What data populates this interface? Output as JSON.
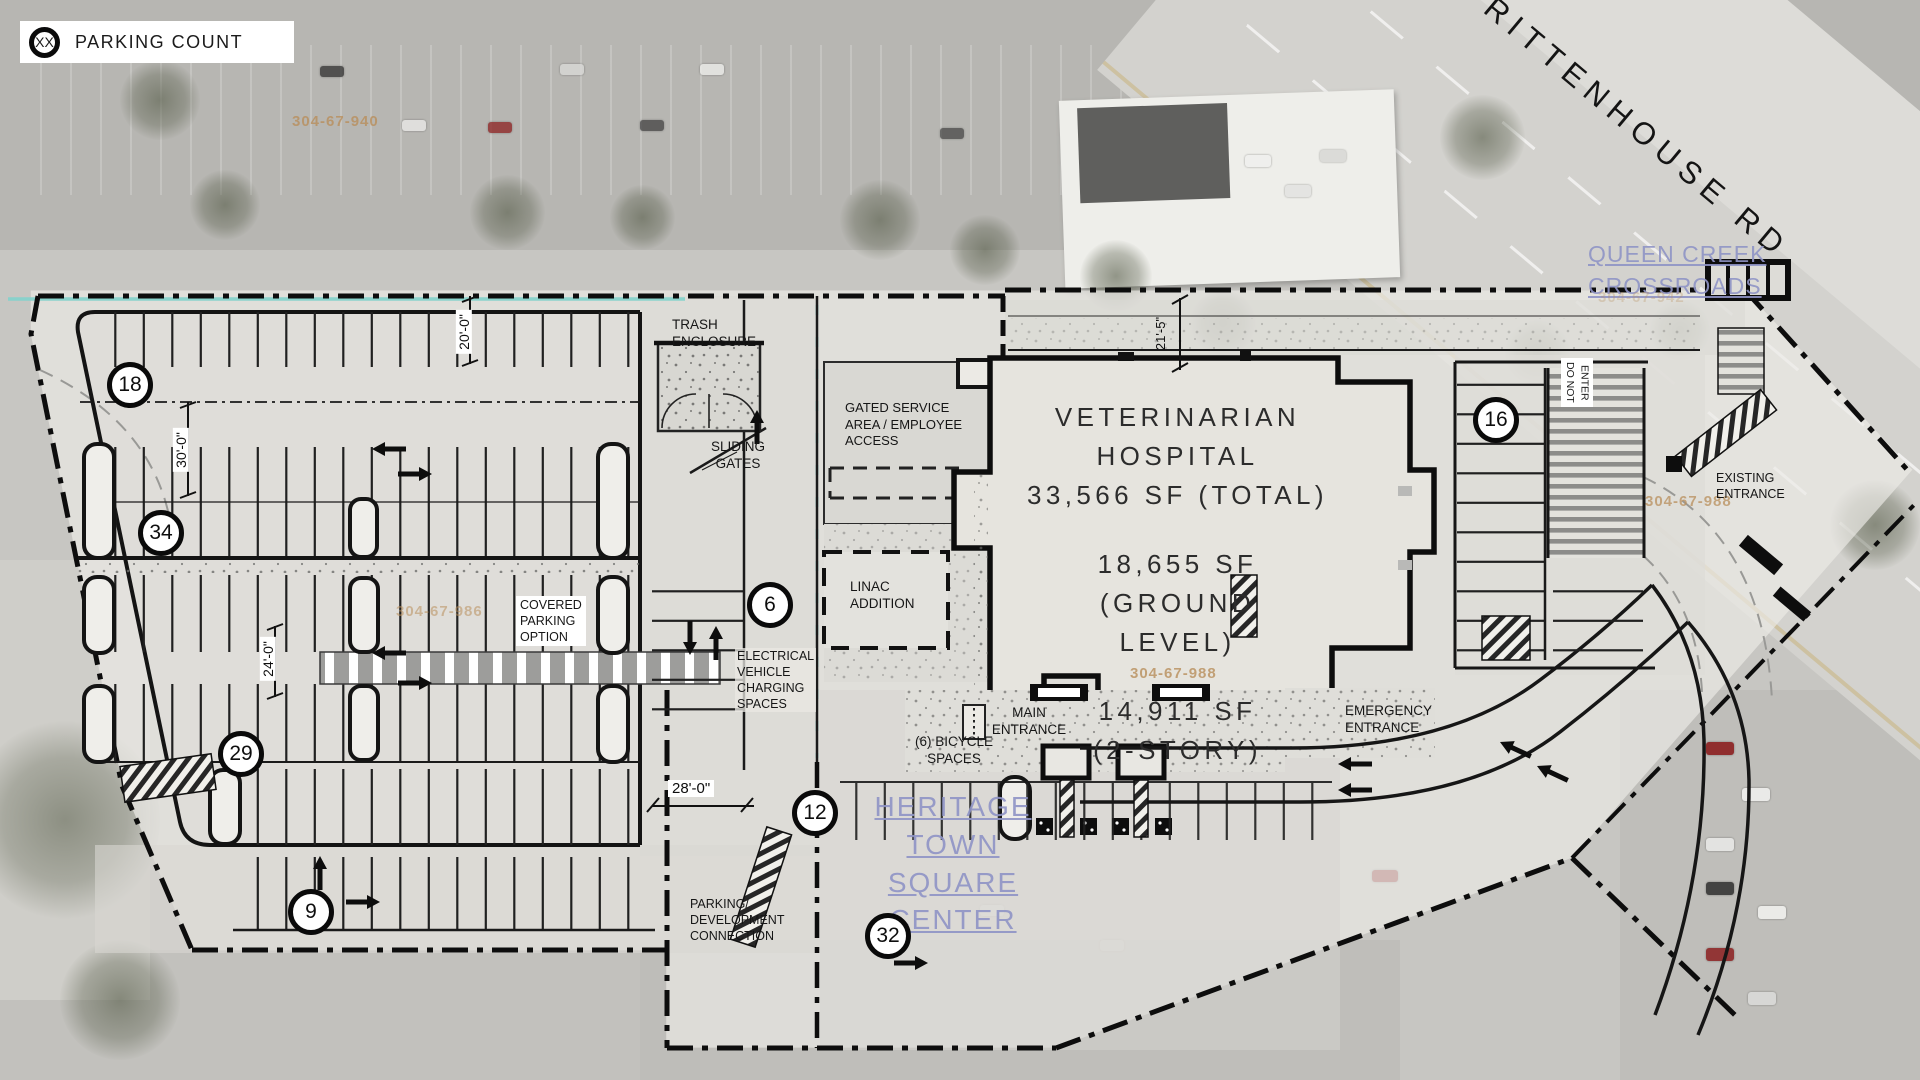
{
  "legend": {
    "symbol": "XX",
    "label": "PARKING COUNT"
  },
  "roads": {
    "rittenhouse": "RITTENHOUSE RD"
  },
  "context": {
    "queen_creek": "QUEEN CREEK\nCROSSROADS",
    "heritage": "HERITAGE TOWN\nSQUARE CENTER"
  },
  "parcels": {
    "p940": "304-67-940",
    "p942": "304-67-942",
    "p986": "304-67-986",
    "p988": "304-67-988",
    "p988_east": "304-67-988"
  },
  "building": {
    "title": "VETERINARIAN\nHOSPITAL\n33,566 SF (TOTAL)",
    "ground": "18,655 SF\n(GROUND\nLEVEL)",
    "upper": "14,911 SF\n(2-STORY)"
  },
  "site_labels": {
    "trash": "TRASH\nENCLOSURE",
    "sliding_gates": "SLIDING\nGATES",
    "gated_service": "GATED SERVICE\nAREA / EMPLOYEE\nACCESS",
    "linac": "LINAC\nADDITION",
    "covered_parking": "COVERED\nPARKING\nOPTION",
    "ev_charging": "ELECTRICAL\nVEHICLE\nCHARGING\nSPACES",
    "main_entrance": "MAIN\nENTRANCE",
    "bicycle": "(6) BICYCLE\nSPACES",
    "emergency": "EMERGENCY\nENTRANCE",
    "existing": "EXISTING\nENTRANCE",
    "do_not_enter": "DO NOT\nENTER",
    "parking_dev": "PARKING/\nDEVELOPMENT\nCONNECTION"
  },
  "dimensions": {
    "aisle_20": "20'-0\"",
    "aisle_30": "30'-0\"",
    "aisle_24": "24'-0\"",
    "entry_28": "28'-0\"",
    "setback_21": "21'-5\""
  },
  "parking_counts": [
    {
      "zone": "northwest-row",
      "value": "18"
    },
    {
      "zone": "west-row-2",
      "value": "34"
    },
    {
      "zone": "west-row-4",
      "value": "29"
    },
    {
      "zone": "southwest-row",
      "value": "9"
    },
    {
      "zone": "ev-row",
      "value": "6"
    },
    {
      "zone": "south-entry-row",
      "value": "12"
    },
    {
      "zone": "heritage-lot",
      "value": "32"
    },
    {
      "zone": "east-lot",
      "value": "16"
    }
  ],
  "colors": {
    "boundary": "#111111",
    "cyan_line": "#86d2cb",
    "parcel_text": "#b98f5c",
    "map_link_text": "#8f94c6",
    "plan_fill": "#deddd8"
  }
}
